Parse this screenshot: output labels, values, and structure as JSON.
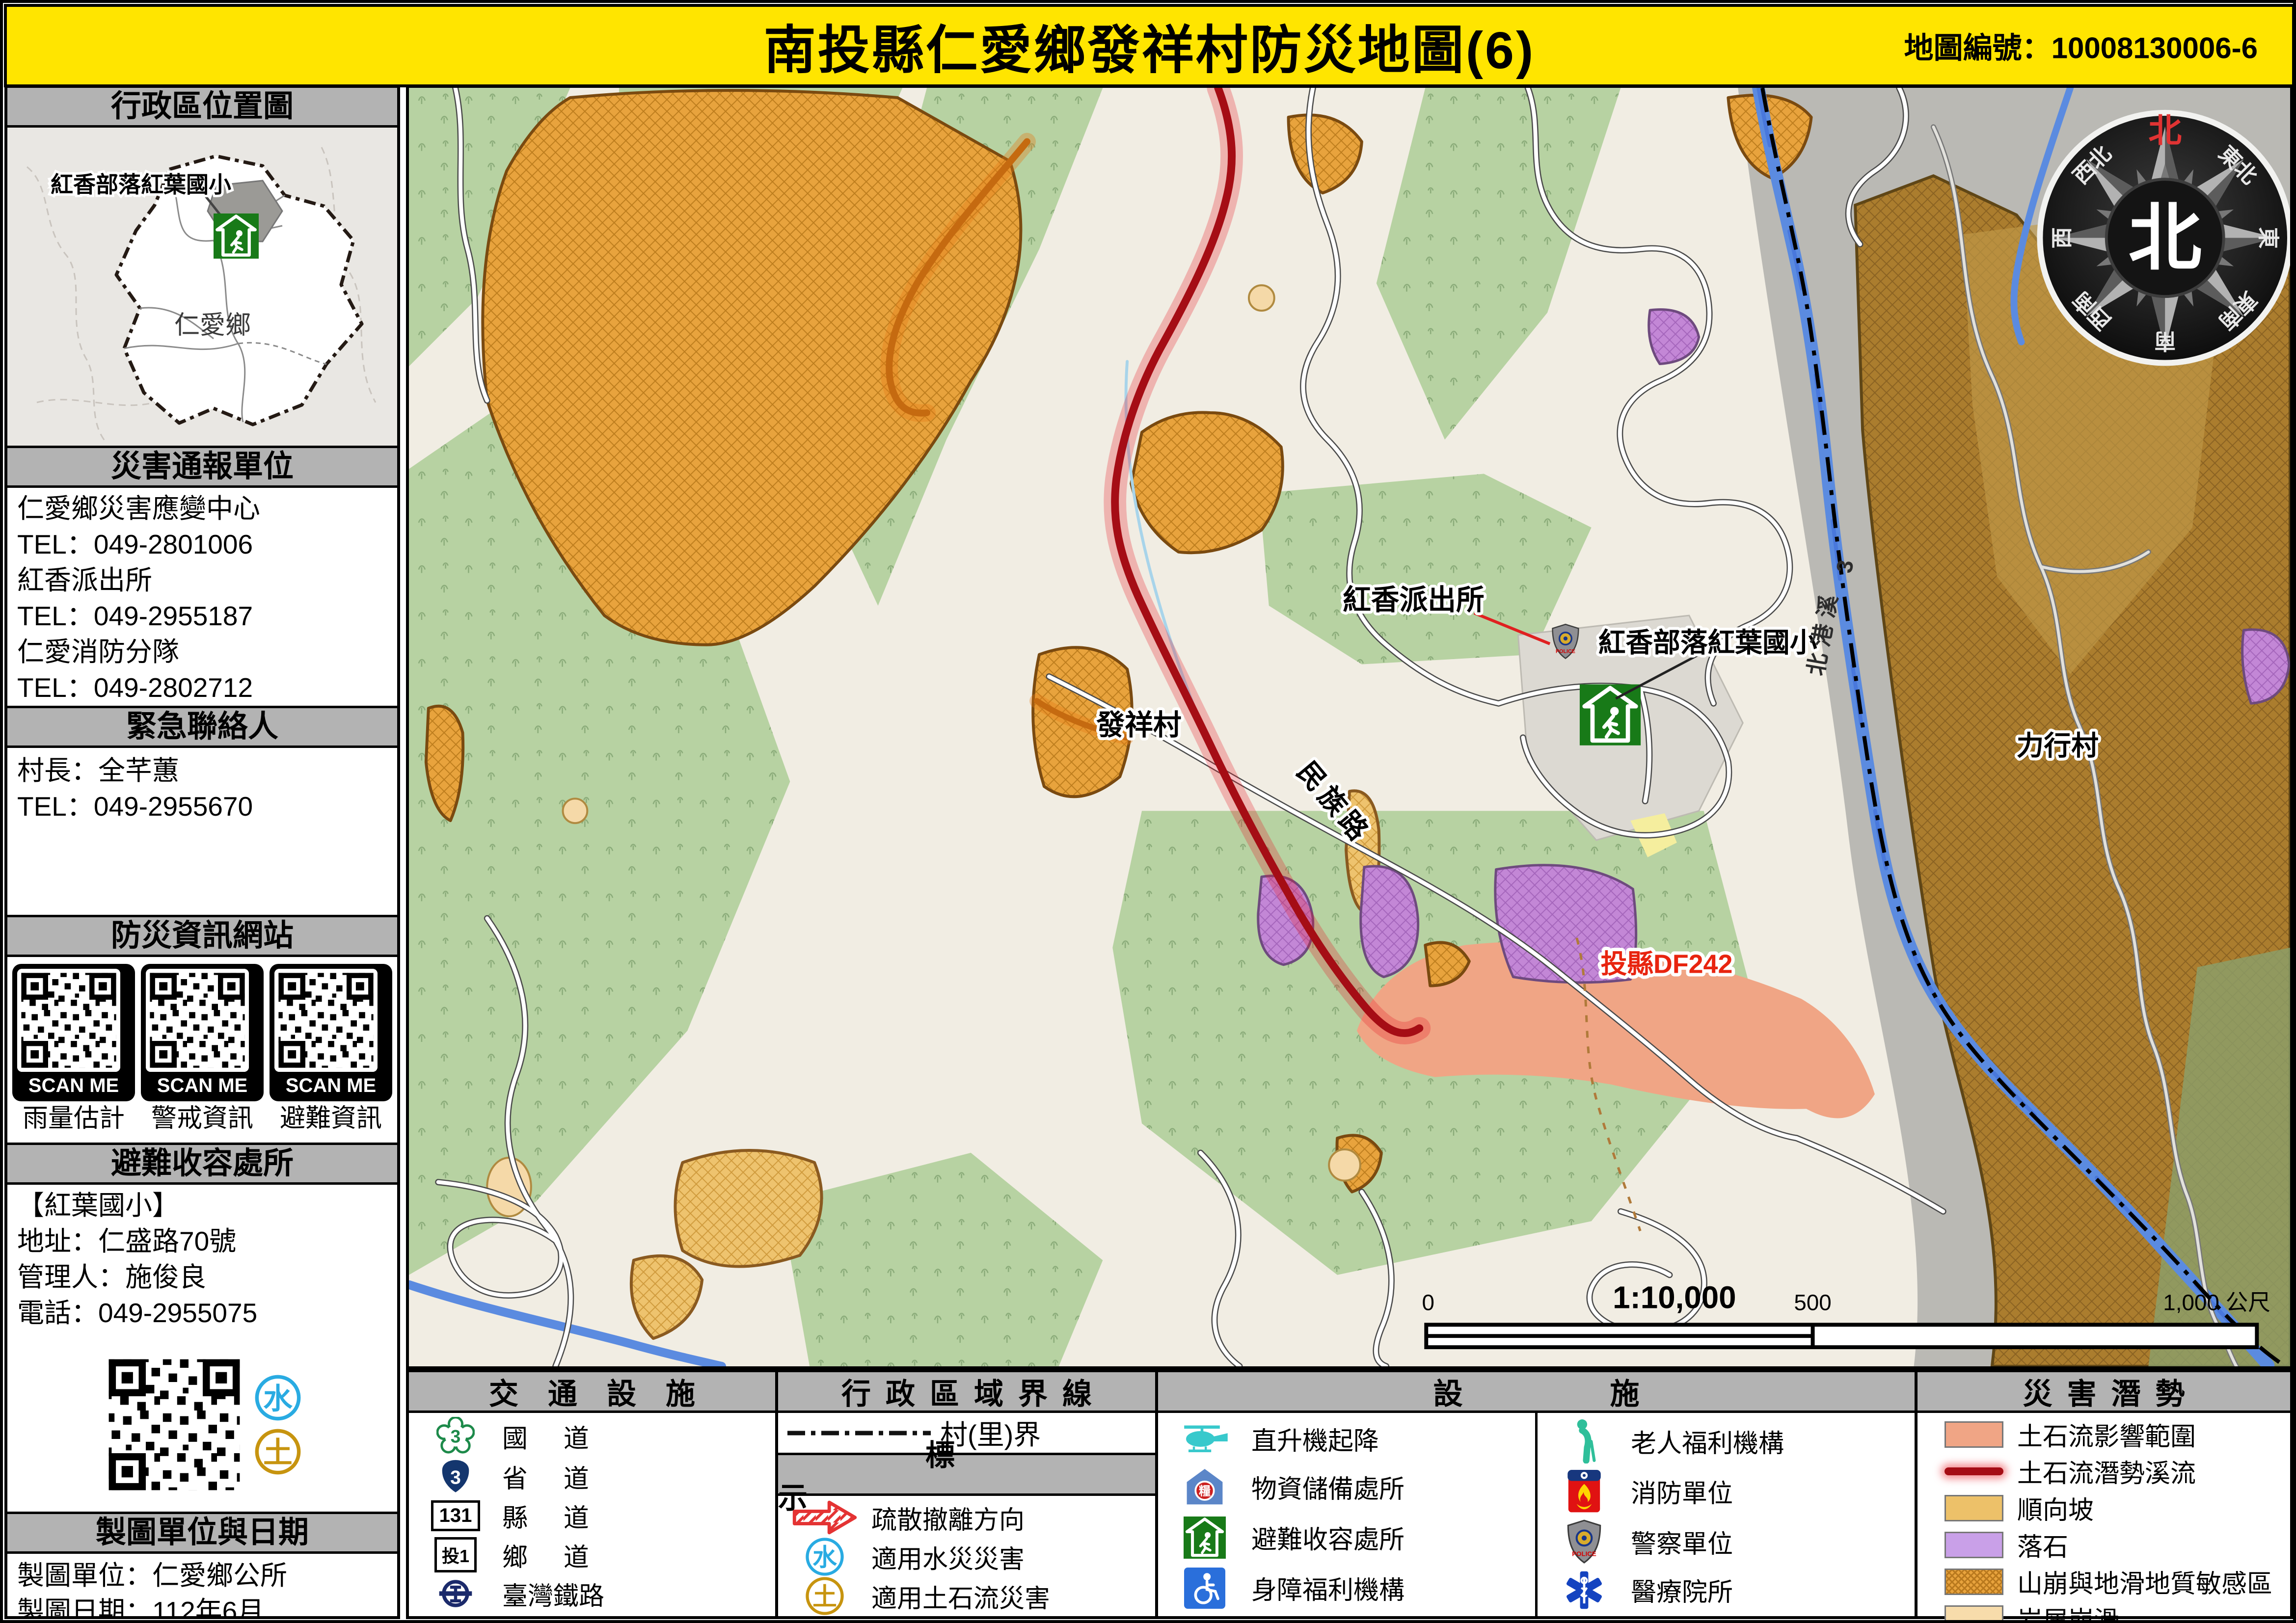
{
  "title": {
    "main": "南投縣仁愛鄉發祥村防災地圖(6)",
    "map_no": "地圖編號：10008130006-6"
  },
  "sidebar": {
    "locator_header": "行政區位置圖",
    "locator": {
      "school": "紅香部落紅葉國小",
      "township": "仁愛鄉"
    },
    "report_header": "災害通報單位",
    "report_lines": [
      "仁愛鄉災害應變中心",
      "TEL：049-2801006",
      "紅香派出所",
      "TEL：049-2955187",
      "仁愛消防分隊",
      "TEL：049-2802712"
    ],
    "emergency_header": "緊急聯絡人",
    "emergency_lines": [
      "村長：全芊蕙",
      "TEL：049-2955670"
    ],
    "web_header": "防災資訊網站",
    "scan_me": "SCAN ME",
    "qr_captions": [
      "雨量估計",
      "警戒資訊",
      "避難資訊"
    ],
    "shelter_header": "避難收容處所",
    "shelter_lines": [
      "【紅葉國小】",
      "地址：仁盛路70號",
      "管理人：施俊良",
      "電話：049-2955075"
    ],
    "credit_header": "製圖單位與日期",
    "credit_lines": [
      "製圖單位：仁愛鄉公所",
      "製圖日期：112年6月"
    ]
  },
  "map": {
    "labels": {
      "police": "紅香派出所",
      "school": "紅香部落紅葉國小",
      "village": "發祥村",
      "road": "民族路",
      "lixing": "力行村",
      "df": "投縣DF242",
      "river": "北港溪",
      "river_no": "3"
    },
    "compass": {
      "n": "北",
      "ne": "東北",
      "e": "東",
      "se": "東南",
      "s": "南",
      "sw": "西南",
      "w": "西",
      "nw": "西北",
      "center": "北"
    },
    "scale": {
      "zero": "0",
      "ratio": "1:10,000",
      "mid": "500",
      "end": "1,000 公尺"
    }
  },
  "legend": {
    "transport_header": "交通設施",
    "transport": [
      {
        "badge": "3",
        "label": "國道"
      },
      {
        "badge": "3",
        "label": "省道"
      },
      {
        "badge": "131",
        "label": "縣道"
      },
      {
        "badge": "投1",
        "label": "鄉道"
      },
      {
        "badge": "",
        "label": "臺灣鐵路"
      }
    ],
    "boundary_header": "行政區域界線",
    "boundary_label": "村(里)界",
    "marks_header": "標示",
    "marks": [
      "疏散撤離方向",
      "適用水災災害",
      "適用土石流災害"
    ],
    "water_char": "水",
    "soil_char": "土",
    "supply_char": "糧",
    "police_text": "POLICE",
    "facilities_header": "設施",
    "facilities_col1": [
      "直升機起降",
      "物資儲備處所",
      "避難收容處所",
      "身障福利機構"
    ],
    "facilities_col2": [
      "老人福利機構",
      "消防單位",
      "警察單位",
      "醫療院所"
    ],
    "hazard_header": "災害潛勢",
    "hazards": [
      "土石流影響範圍",
      "土石流潛勢溪流",
      "順向坡",
      "落石",
      "山崩與地滑地質敏感區",
      "岩屑崩滑"
    ],
    "colors": {
      "debris_impact": "#f0a585",
      "debris_stream": "#a50d15",
      "dip_slope": "#edc169",
      "rockfall": "#c9a0e8",
      "landslide_zone": "#e8a33d",
      "debris_slide": "#f7dcab",
      "accent_yellow": "#ffe500"
    }
  }
}
